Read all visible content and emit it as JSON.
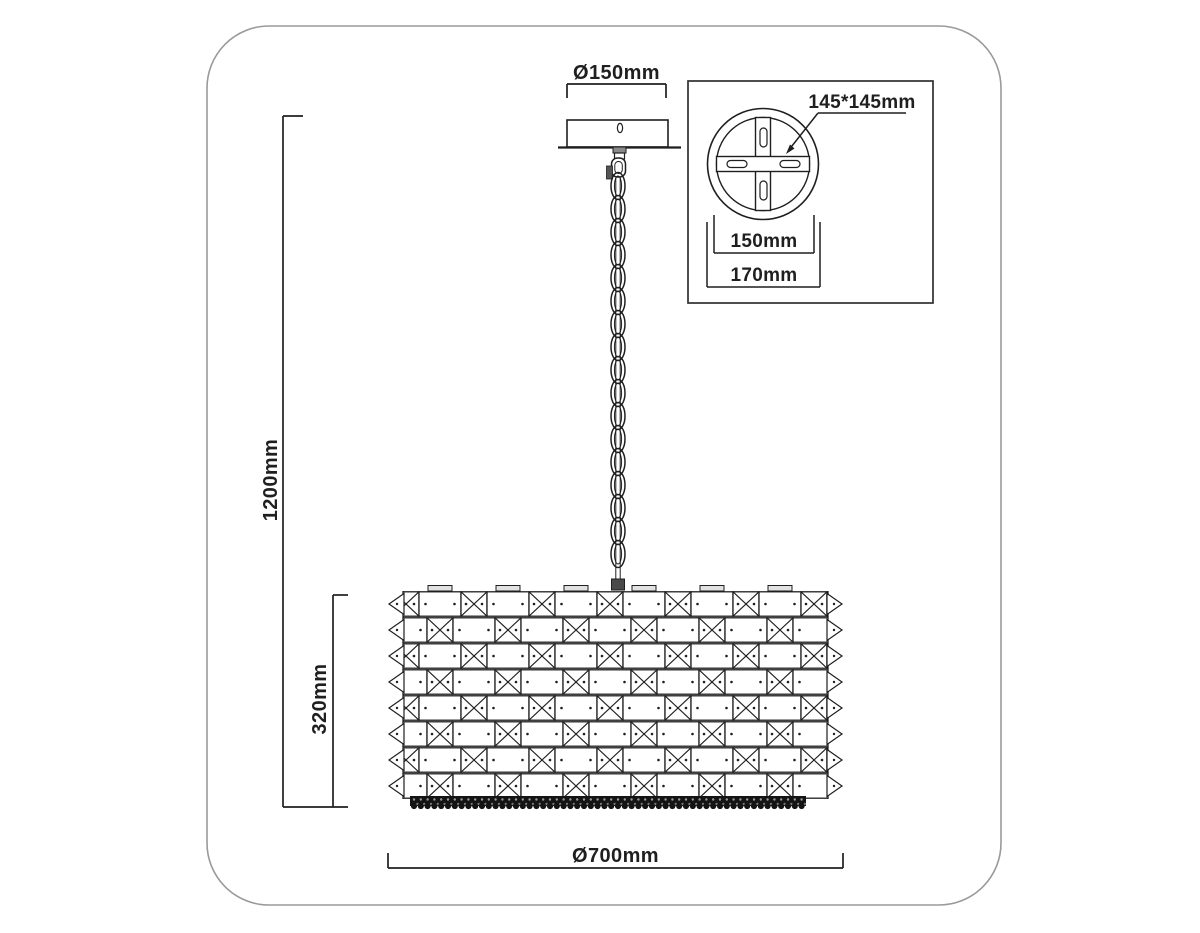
{
  "diagram": {
    "type": "pendant-chandelier-dimensional-drawing",
    "dimensions": {
      "canopy_diameter": "Ø150mm",
      "total_height": "1200mm",
      "shade_height": "320mm",
      "shade_diameter": "Ø700mm"
    },
    "inset": {
      "plate_size": "145*145mm",
      "plate_inner_diameter": "150mm",
      "plate_outer_diameter": "170mm"
    },
    "colors": {
      "line": "#1f1f1f",
      "frame_border": "#9a9a9a",
      "bead_band": "#141414",
      "background": "#ffffff"
    }
  }
}
